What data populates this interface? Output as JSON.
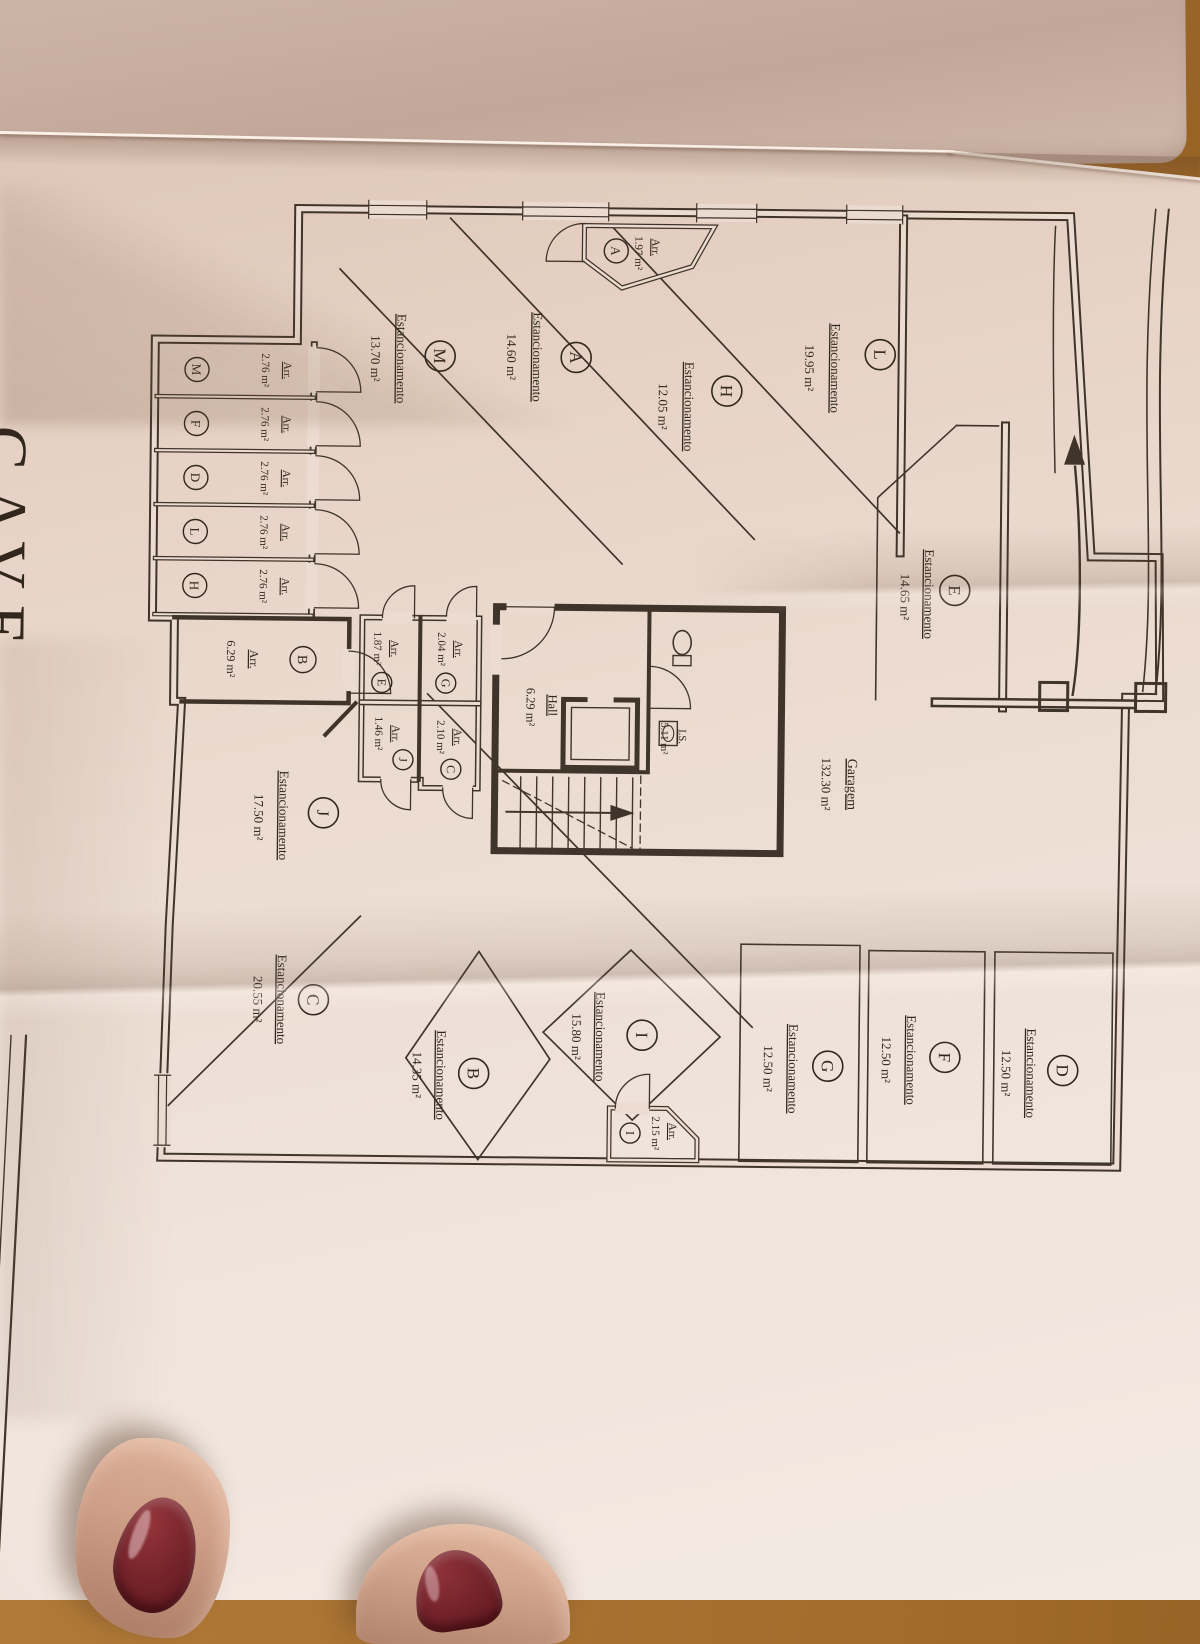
{
  "document": {
    "floor_title": "CAVE",
    "corner_text": "-2"
  },
  "words": {
    "parking": "Estancionamento",
    "storage": "Arr."
  },
  "garage": {
    "label": "Garagem",
    "area": "132.30 m²"
  },
  "hall": {
    "label": "Hall",
    "area": "6.29 m²"
  },
  "wc": {
    "label": "I.S.",
    "area": "5.11 m²"
  },
  "parking": [
    {
      "letter": "L",
      "area": "19.95 m²"
    },
    {
      "letter": "H",
      "area": "12.05 m²"
    },
    {
      "letter": "A",
      "area": "14.60 m²"
    },
    {
      "letter": "M",
      "area": "13.70 m²"
    },
    {
      "letter": "E",
      "area": "14.65 m²"
    },
    {
      "letter": "J",
      "area": "17.50 m²"
    },
    {
      "letter": "C",
      "area": "20.55 m²"
    },
    {
      "letter": "B",
      "area": "14.35 m²"
    },
    {
      "letter": "I",
      "area": "15.80 m²"
    },
    {
      "letter": "G",
      "area": "12.50 m²"
    },
    {
      "letter": "F",
      "area": "12.50 m²"
    },
    {
      "letter": "D",
      "area": "12.50 m²"
    }
  ],
  "storage": [
    {
      "letter": "A",
      "area": "1.97 m²"
    },
    {
      "letter": "M",
      "area": "2.76 m²"
    },
    {
      "letter": "F",
      "area": "2.76 m²"
    },
    {
      "letter": "D",
      "area": "2.76 m²"
    },
    {
      "letter": "L",
      "area": "2.76 m²"
    },
    {
      "letter": "H",
      "area": "2.76 m²"
    },
    {
      "letter": "B",
      "area": "6.29 m²"
    },
    {
      "letter": "E",
      "area": "1.87 m²"
    },
    {
      "letter": "G",
      "area": "2.04 m²"
    },
    {
      "letter": "J",
      "area": "1.46 m²"
    },
    {
      "letter": "C",
      "area": "2.10 m²"
    },
    {
      "letter": "I",
      "area": "2.15 m²"
    }
  ],
  "colors": {
    "ink": "#32271d",
    "sheet": "#ecdcd1",
    "back_sheet": "#c2a799",
    "wood": "#a9743b",
    "nail_polish": "#6b1f22",
    "skin": "#cf9f87"
  }
}
